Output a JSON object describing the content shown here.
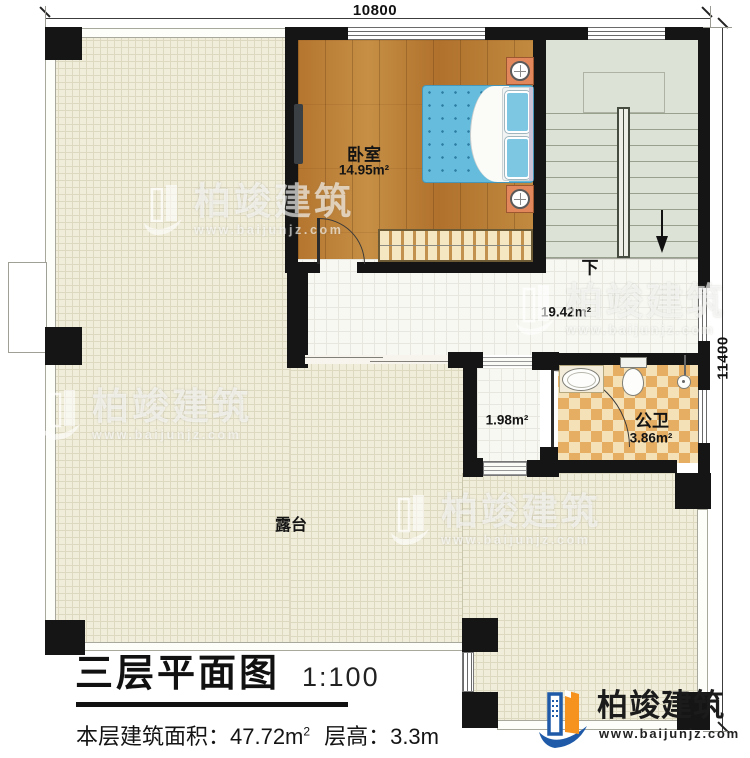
{
  "dimensions": {
    "top": "10800",
    "right": "11400"
  },
  "rooms": {
    "bedroom": {
      "name": "卧室",
      "area": "14.95m²"
    },
    "hallway": {
      "area": "19.42m²"
    },
    "corridor": {
      "area": "1.98m²"
    },
    "bathroom": {
      "name": "公卫",
      "area": "3.86m²"
    },
    "terrace": {
      "name": "露台"
    },
    "stairs": {
      "down_label": "下"
    }
  },
  "title_block": {
    "title": "三层平面图",
    "scale": "1:100",
    "info_prefix": "本层建筑面积：47.72m",
    "info_sup": "2",
    "info_suffix": "层高：3.3m"
  },
  "brand": {
    "name": "柏竣建筑",
    "url": "www.baijunjz.com"
  },
  "colors": {
    "wall": "#151515",
    "wood_floor": "#b97f3a",
    "terrace_floor": "#f0edda",
    "stair_floor": "#dde2d7",
    "tile_floor": "#f8f8f3",
    "bath_tile_light": "#f5e1b7",
    "bath_tile_dark": "#e6ae63",
    "bed_blue": "#66bcdc",
    "brand_blue": "#1e5aa8",
    "brand_orange": "#f6921e"
  }
}
